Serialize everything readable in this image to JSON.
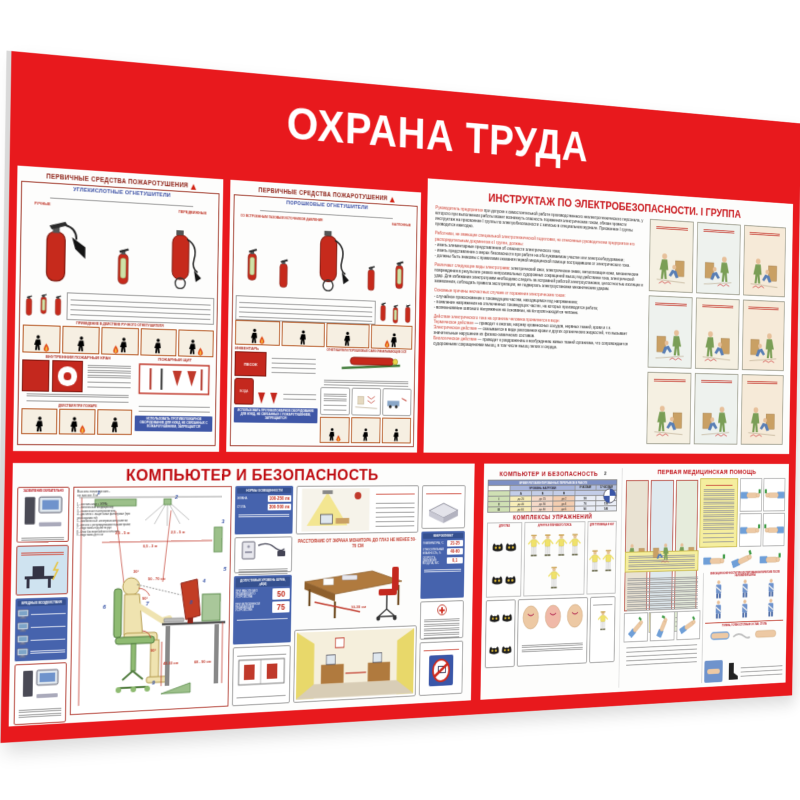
{
  "board": {
    "title": "ОХРАНА ТРУДА",
    "red": "#e8191d"
  },
  "fire": {
    "header": "ПЕРВИЧНЫЕ СРЕДСТВА ПОЖАРОТУШЕНИЯ",
    "co2": {
      "subtitle": "УГЛЕКИСЛОТНЫЕ ОГНЕТУШИТЕЛИ",
      "label_manual": "РУЧНЫЕ",
      "label_mobile": "ПЕРЕДВИЖНЫЕ",
      "strip_caption": "ПРИВЕДЕНИЕ В ДЕЙСТВИЕ РУЧНОГО ОГНЕТУШИТЕЛЯ",
      "crane_title": "ВНУТРЕННИЙ ПОЖАРНЫЙ КРАН",
      "shield_title": "ПОЖАРНЫЙ ЩИТ",
      "actions_caption": "ДЕЙСТВИЯ ПРИ ПОЖАРЕ",
      "warning": "ИСПОЛЬЗОВАТЬ ПРОТИВОПОЖАРНОЕ ОБОРУДОВАНИЕ ДЛЯ НУЖД, НЕ СВЯЗАННЫХ С ПОЖАРОТУШЕНИЕМ, ЗАПРЕЩАЕТСЯ!"
    },
    "powder": {
      "subtitle": "ПОРОШКОВЫЕ ОГНЕТУШИТЕЛИ",
      "label_gas": "СО ВСТРОЕННЫМ ГАЗОВЫМ ИСТОЧНИКОМ ДАВЛЕНИЯ",
      "label_balloon": "БАЛЛОННЫЕ",
      "inventory_title": "ИНВЕНТАРЬ",
      "sand": "ПЕСОК",
      "water": "ВОДА",
      "osp_caption": "ОГНЕТУШИТЕЛИ ПОРОШКОВЫЕ САМОСРАБАТЫВАЮЩИЕ ОСП",
      "warning": "ИСПОЛЬЗОВАТЬ ПРОТИВОПОЖАРНОЕ ОБОРУДОВАНИЕ ДЛЯ НУЖД, НЕ СВЯЗАННЫХ С ПОЖАРОТУШЕНИЕМ, ЗАПРЕЩАЕТСЯ!"
    }
  },
  "electro": {
    "title": "ИНСТРУКТАЖ ПО ЭЛЕКТРОБЕЗОПАСНОСТИ. I ГРУППА",
    "p1_lead": "Руководитель предприятия",
    "p1_body": "при допуске к самостоятельной работе производственного неэлектротехнического персонала, у которого при выполнении работы может возникнуть опасность поражения электрическим током, обязан провести инструктаж на присвоение I группы по электробезопасности с записью в специальном журнале. Присвоение I группы проводится ежегодно.",
    "p2_lead": "Работники, не имеющие специальной электротехнической подготовки, но отнесенные руководителем предприятия его распорядительным документом к I группе, должны:",
    "p2_body": "- иметь элементарные представления об опасности электрического тока;\n- иметь представление о мерах безопасности при работе на обслуживаемом участке или электрооборудовании;\n- должны быть знакомы с правилами оказания первой медицинской помощи пострадавшим от электрического тока.",
    "p3_lead": "Различают следующие виды электротравм:",
    "p3_body": "электрический ожог, электрические знаки, металлизация кожи, механические повреждения в результате резких непроизвольных судорожных сокращений мышц под действием тока, электрический удар. Для избежания электротравм необходимо следить за исправной работой электроустановок, целостностью изоляции и заземления, соблюдать правила эксплуатации, не подвергать электроустановки механическим ударам.",
    "p4_lead": "Основные причины несчастных случаев от поражения электрическим током:",
    "p4_body": "- случайное прикосновение к токоведущим частям, находящимся под напряжением;\n- появление напряжения на отключенных токоведущих частях, на которых производится работа;\n- возникновение шагового напряжения на основании, на котором находится человек.",
    "p5_lead": "Действие электрического тока на организм человека проявляется в виде:",
    "p5_items": [
      {
        "lead": "Термическое действие",
        "body": "— приводит к ожогам, нагреву кровеносных сосудов, нервных тканей, крови и т.п."
      },
      {
        "lead": "Электрическое действие",
        "body": "— сказывается в виде разложения крови и других органических жидкостей, что вызывает значительные нарушения их физико-химических составов."
      },
      {
        "lead": "Биологическое действие",
        "body": "— приводит к раздражению и возбуждению живых тканей организма, что сопровождается судорожными сокращениями мышц, в том числе мышц легких и сердца."
      }
    ]
  },
  "comp1": {
    "title": "КОМПЬЮТЕР И БЕЗОПАСНОСТЬ",
    "grounding_caption": "ЗАЗЕМЛЕНИЕ ОБЯЗАТЕЛЬНО",
    "hazards_caption": "ВРЕДНЫЕ ВОЗДЕЙСТВИЯ",
    "room_note": "Высота помещения -\nне менее 3 м",
    "equipment_list": "1 - светильники с ЭПРА;\n2 - потолочный кондиционер;\n3 - наоконные пылеуловители;\n4 - дисплеи с защитными фильтрами (при необходимости);\n5 - заземленные электрические розетки;\n6 - кресло с регулируемыми параметрами;\n7 - подставка под кисти рук;\n8 - блок бесперебойного питания;\n9 - подставка для ног",
    "dims": {
      "ceiling_a": "2,5 - 5 м",
      "ceiling_b": "2,5 - 5 м",
      "row": "0,5 - 3 м",
      "eyes": "50 - 70 см",
      "angle_view": "30°",
      "angle_elbow": "90°",
      "angle_knee": "90°",
      "seat": "42-53 см",
      "table": "68 - 90 см",
      "desk_edge": "10-30 см"
    },
    "numbers": [
      "1",
      "2",
      "3",
      "4",
      "5",
      "6",
      "7",
      "8",
      "9"
    ],
    "lighting": {
      "title": "НОРМЫ ОСВЕЩЕННОСТИ",
      "row1_label": "ЭКРАНА",
      "row1_value": "100-250 лк",
      "row2_label": "СТОЛА",
      "row2_value": "300-500 лк"
    },
    "noise": {
      "title": "ДОПУСТИМЫЙ УРОВЕНЬ ШУМА, дБ(А)",
      "row1_label": "ПРИ РАБОТЕ БЕЗ ПЕЧАТАЮЩЕГО УСТРОЙСТВА",
      "row1_value": "50",
      "row2_label": "ПРИ ВКЛЮЧЕННОМ ПЕЧАТАЮЩЕМ УСТРОЙСТВЕ",
      "row2_value": "75"
    },
    "distance_note": "РАССТОЯНИЕ ОТ ЭКРАНА МОНИТОРА ДО ГЛАЗ НЕ МЕНЕЕ 50-70 СМ",
    "microclimate": {
      "title": "МИКРОКЛИМАТ",
      "row1_label": "ТЕМПЕРАТУРА, °С",
      "row1_value": "21-25",
      "row2_label": "ОТНОСИТЕЛЬНАЯ ВЛАЖНОСТЬ, %",
      "row2_value": "40-60",
      "row3_label": "СКОРОСТЬ ДВИЖЕНИЯ ВОЗДУХА, М/С",
      "row3_value": "0,1"
    }
  },
  "comp2": {
    "title": "КОМПЬЮТЕР И БЕЗОПАСНОСТЬ",
    "page": "2",
    "table": {
      "title": "ВРЕМЯ РЕГЛАМЕНТИРОВАННЫХ ПЕРЕРЫВОВ В РАБОТЕ",
      "load_header": "УРОВЕНЬ НАГРУЗКИ",
      "col_a": "А",
      "col_b": "Б",
      "col_c": "В",
      "col_h8": "8 ЧАСОВАЯ",
      "col_h12": "12 ЧАСОВАЯ",
      "rows": [
        [
          "I",
          "до 20",
          "до 15",
          "до 2",
          "50",
          "80"
        ],
        [
          "II",
          "до 40",
          "до 30",
          "до 4",
          "70",
          "110"
        ],
        [
          "III",
          "до 60",
          "до 40",
          "до 6",
          "90",
          "140"
        ]
      ]
    },
    "exercises_title": "КОМПЛЕКСЫ УПРАЖНЕНИЙ",
    "group_eyes": "ДЛЯ ГЛАЗ",
    "group_arms": "ДЛЯ РУК И ПЛЕЧЕВОГО ПОЯСА",
    "group_body": "ДЛЯ ТУЛОВИЩА И НОГ"
  },
  "firstaid": {
    "title": "ПЕРВАЯ МЕДИЦИНСКАЯ ПОМОЩЬ",
    "fixation_caption": "ФИКСАЦИЯ КОНЕЧНОСТИ ПРИ ИЗОЛИРОВАННОМ ПЕРЕЛОМЕ ПОСЛЕ НАЛОЖЕНИЯ ШИНЫ",
    "leg_caption": "ГОЛЕНЬ, ГОЛЕНОСТОПНЫЙ СУСТАВ, СТОПА"
  }
}
